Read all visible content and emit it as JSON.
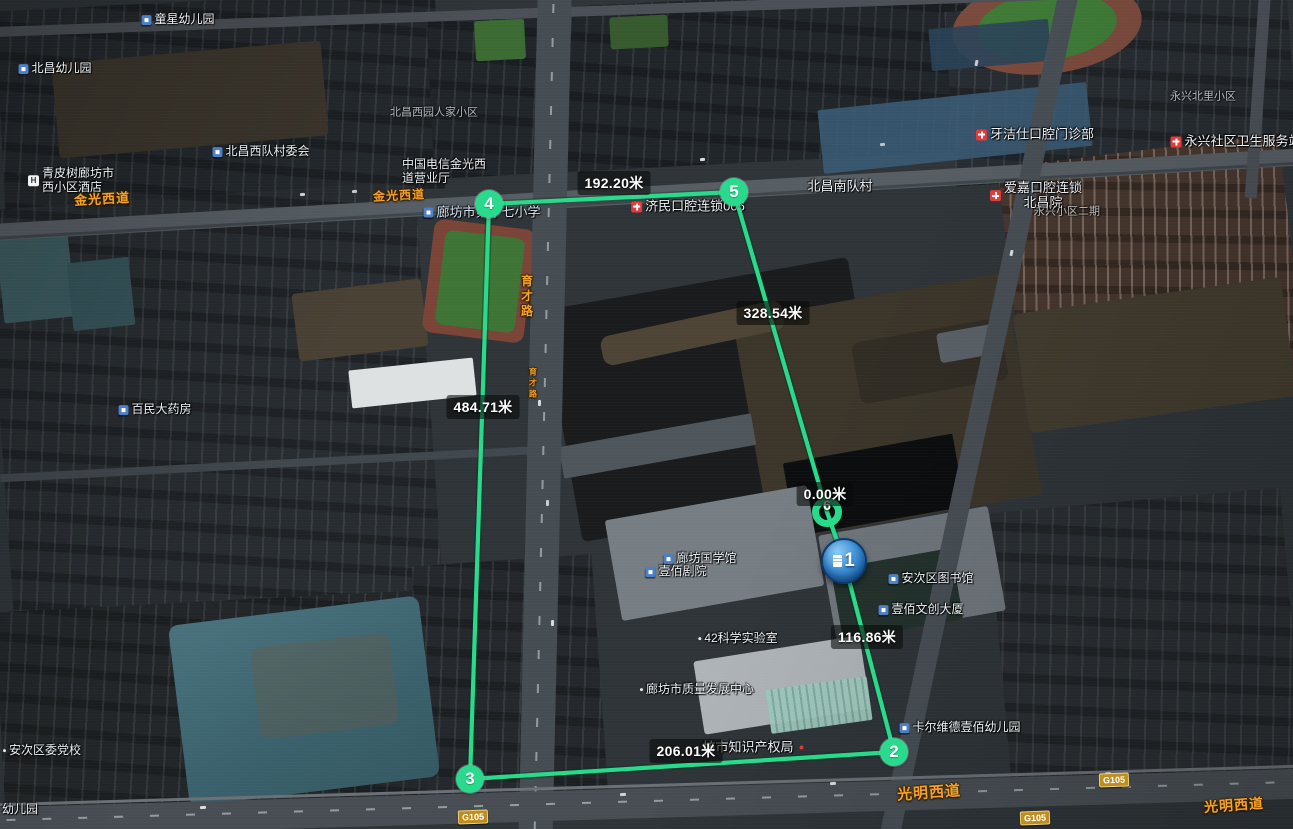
{
  "measurement": {
    "unit": "米",
    "path_color": "#29da8c",
    "points": [
      {
        "n": "1",
        "style": "blue-placemark",
        "x": 844,
        "y": 561
      },
      {
        "n": "2",
        "style": "green",
        "x": 894,
        "y": 752
      },
      {
        "n": "3",
        "style": "green",
        "x": 470,
        "y": 779
      },
      {
        "n": "4",
        "style": "green",
        "x": 489,
        "y": 204
      },
      {
        "n": "5",
        "style": "green",
        "x": 734,
        "y": 192
      },
      {
        "n": "6",
        "style": "green-ring",
        "x": 827,
        "y": 512
      }
    ],
    "polyline": [
      [
        844,
        561
      ],
      [
        894,
        752
      ],
      [
        470,
        779
      ],
      [
        489,
        204
      ],
      [
        734,
        192
      ],
      [
        827,
        512
      ],
      [
        844,
        561
      ]
    ],
    "segment_labels": [
      {
        "text": "116.86米",
        "x": 867,
        "y": 637
      },
      {
        "text": "206.01米",
        "x": 686,
        "y": 751
      },
      {
        "text": "484.71米",
        "x": 483,
        "y": 407
      },
      {
        "text": "192.20米",
        "x": 614,
        "y": 183
      },
      {
        "text": "328.54米",
        "x": 773,
        "y": 313
      },
      {
        "text": "0.00米",
        "x": 825,
        "y": 494
      }
    ]
  },
  "road_labels": [
    {
      "text": "金光西道",
      "x": 102,
      "y": 198,
      "rot": -3,
      "size": 13
    },
    {
      "text": "金光西道",
      "x": 399,
      "y": 195,
      "rot": -3,
      "size": 12
    },
    {
      "text": "光明西道",
      "x": 929,
      "y": 792,
      "rot": -4,
      "size": 15
    },
    {
      "text": "光明西道",
      "x": 1234,
      "y": 805,
      "rot": -4,
      "size": 14
    },
    {
      "text": "育才路",
      "x": 527,
      "y": 297,
      "vertical": true,
      "size": 12
    },
    {
      "text": "育才路",
      "x": 533,
      "y": 384,
      "vertical": true,
      "size": 8
    }
  ],
  "highway_shields": [
    {
      "text": "G105",
      "x": 473,
      "y": 817
    },
    {
      "text": "G105",
      "x": 1114,
      "y": 780
    },
    {
      "text": "G105",
      "x": 1035,
      "y": 818
    }
  ],
  "pois": [
    {
      "lines": [
        "童星幼儿园"
      ],
      "x": 178,
      "y": 20,
      "icon": "bld"
    },
    {
      "lines": [
        "北昌幼儿园"
      ],
      "x": 55,
      "y": 69,
      "icon": "bld"
    },
    {
      "lines": [
        "北昌西园人家小区"
      ],
      "x": 434,
      "y": 113,
      "cls": "faint"
    },
    {
      "lines": [
        "青皮树廊坊市",
        "西小区酒店"
      ],
      "x": 28,
      "y": 181,
      "icon": "h",
      "align": "left"
    },
    {
      "lines": [
        "中国电信金光西",
        "道营业厅"
      ],
      "x": 402,
      "y": 172,
      "align": "left"
    },
    {
      "lines": [
        "北昌西队村委会"
      ],
      "x": 261,
      "y": 152,
      "icon": "bld"
    },
    {
      "lines": [
        "廊坊市第十七小学"
      ],
      "x": 482,
      "y": 213,
      "icon": "bld",
      "cls": "school"
    },
    {
      "lines": [
        "济民口腔连锁006"
      ],
      "x": 688,
      "y": 207,
      "icon": "cross",
      "cls": "big"
    },
    {
      "lines": [
        "北昌南队村"
      ],
      "x": 840,
      "y": 187,
      "cls": "big"
    },
    {
      "lines": [
        "爱嘉口腔连锁",
        "北昌院"
      ],
      "x": 1036,
      "y": 196,
      "icon": "cross",
      "cls": "big"
    },
    {
      "lines": [
        "永兴小区二期"
      ],
      "x": 1067,
      "y": 212,
      "cls": "faint"
    },
    {
      "lines": [
        "牙洁仕口腔门诊部"
      ],
      "x": 1035,
      "y": 135,
      "icon": "cross",
      "cls": "big"
    },
    {
      "lines": [
        "永兴社区卫生服务站"
      ],
      "x": 1236,
      "y": 142,
      "icon": "cross",
      "cls": "big"
    },
    {
      "lines": [
        "永兴北里小区"
      ],
      "x": 1203,
      "y": 97,
      "cls": "faint"
    },
    {
      "lines": [
        "百民大药房"
      ],
      "x": 155,
      "y": 410,
      "icon": "bld"
    },
    {
      "lines": [
        "安次区委党校"
      ],
      "x": 42,
      "y": 751,
      "icon": "dot"
    },
    {
      "lines": [
        "幼儿园"
      ],
      "x": 2,
      "y": 810,
      "align": "left"
    },
    {
      "lines": [
        "廊坊市质量发展中心"
      ],
      "x": 697,
      "y": 690,
      "icon": "dot"
    },
    {
      "lines": [
        "42科学实验室"
      ],
      "x": 738,
      "y": 639,
      "icon": "dot"
    },
    {
      "lines": [
        "廊坊国学馆"
      ],
      "x": 700,
      "y": 559,
      "icon": "bld"
    },
    {
      "lines": [
        "壹佰剧院"
      ],
      "x": 676,
      "y": 572,
      "icon": "bld"
    },
    {
      "lines": [
        "安次区图书馆"
      ],
      "x": 931,
      "y": 579,
      "icon": "bld"
    },
    {
      "lines": [
        "壹佰文创大厦"
      ],
      "x": 921,
      "y": 610,
      "icon": "bld"
    },
    {
      "lines": [
        "卡尔维德壹佰幼儿园"
      ],
      "x": 960,
      "y": 728,
      "icon": "bld"
    },
    {
      "lines": [
        "坊市知识产权局"
      ],
      "x": 753,
      "y": 748,
      "icon": "dot-after",
      "cls": "big"
    }
  ]
}
